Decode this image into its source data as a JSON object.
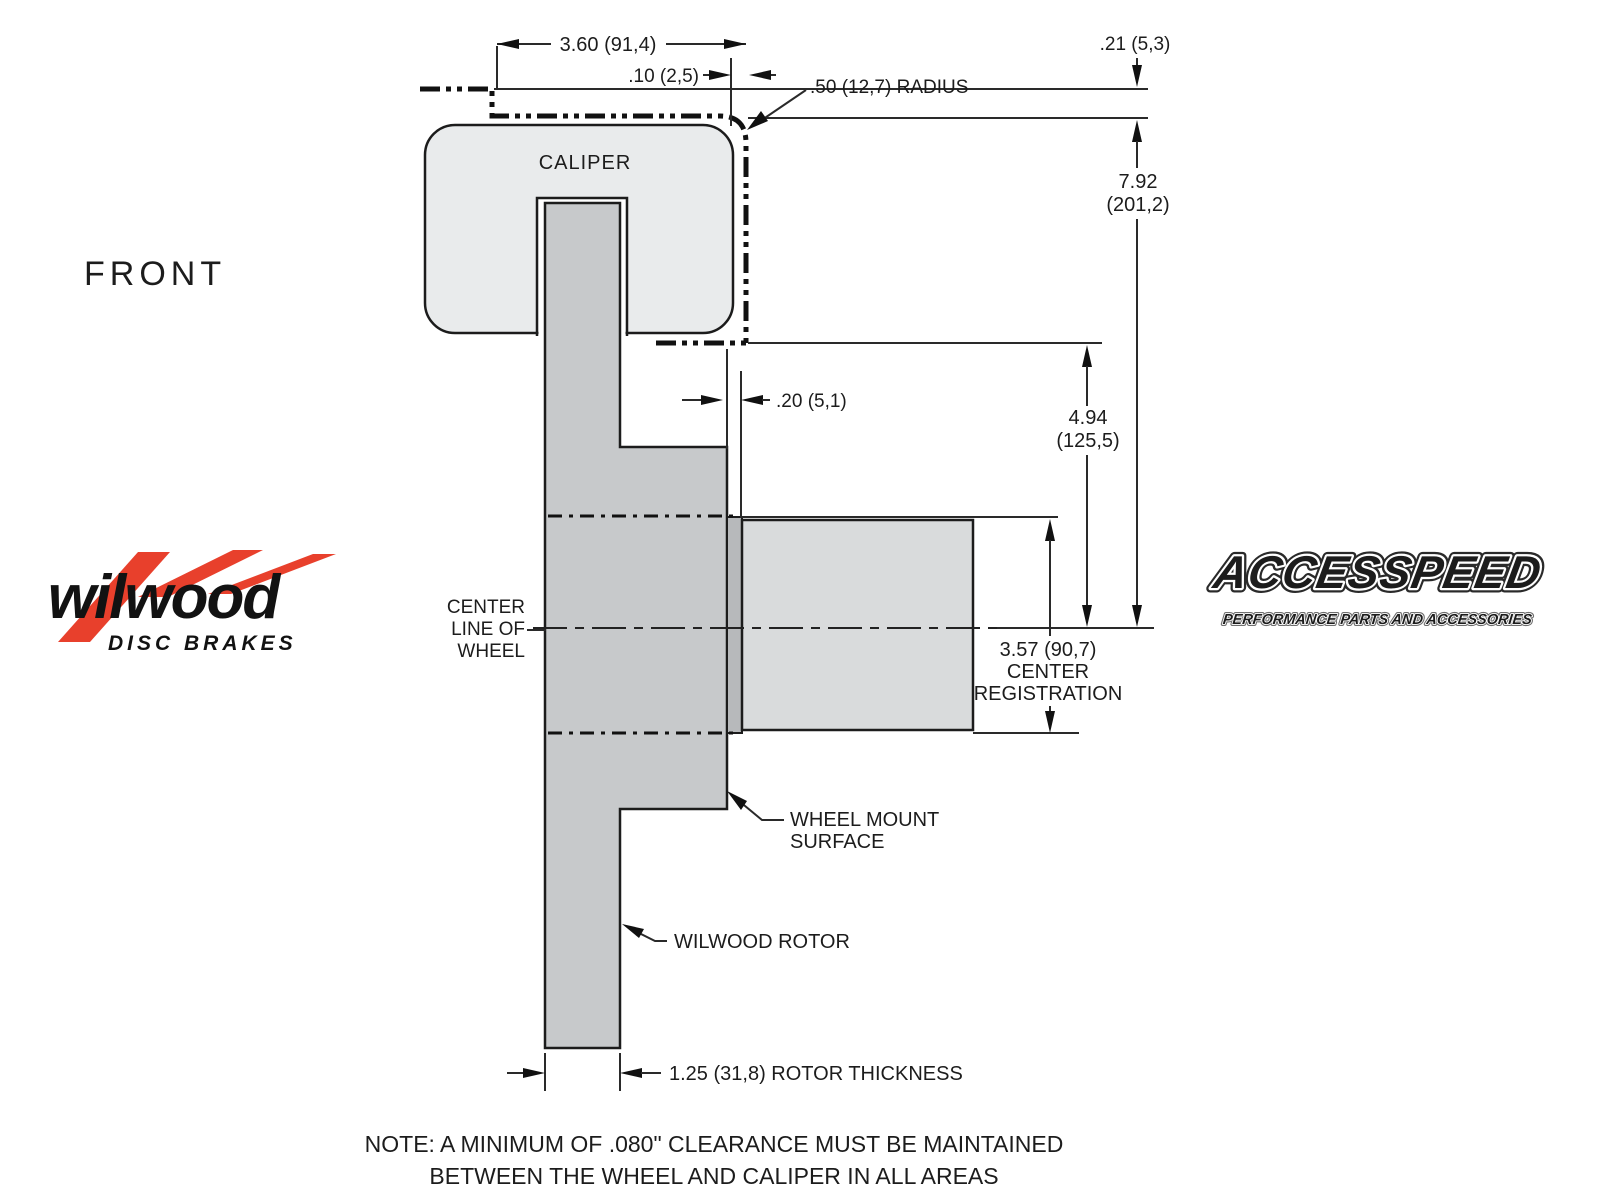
{
  "view_label": "FRONT",
  "colors": {
    "caliper_fill": "#e9ebec",
    "rotor_fill": "#c7c9cb",
    "flange_fill": "#b7b9bb",
    "registration_fill": "#d9dbdc",
    "line": "#1c1c1c",
    "wilwood_red": "#e8402c"
  },
  "caliper": {
    "label": "CALIPER"
  },
  "dimensions": {
    "caliper_width": "3.60 (91,4)",
    "edge_gap": ".10 (2,5)",
    "corner_radius": ".50 (12,7) RADIUS",
    "top_clearance": ".21 (5,3)",
    "outer_radius_in": "7.92",
    "outer_radius_mm": "(201,2)",
    "mount_offset": ".20 (5,1)",
    "inner_radius_in": "4.94",
    "inner_radius_mm": "(125,5)",
    "registration_dia": "3.57 (90,7)",
    "registration_word1": "CENTER",
    "registration_word2": "REGISTRATION",
    "rotor_thickness": "1.25 (31,8) ROTOR THICKNESS"
  },
  "labels": {
    "centerline_1": "CENTER",
    "centerline_2": "LINE OF",
    "centerline_3": "WHEEL",
    "wheel_mount_1": "WHEEL MOUNT",
    "wheel_mount_2": "SURFACE",
    "rotor": "WILWOOD ROTOR"
  },
  "note": {
    "line1": "NOTE: A MINIMUM OF .080\" CLEARANCE MUST BE MAINTAINED",
    "line2": "BETWEEN THE WHEEL AND CALIPER IN ALL AREAS"
  },
  "logos": {
    "wilwood": {
      "name": "wilwood",
      "tagline": "DISC BRAKES"
    },
    "accesspeed": {
      "name": "ACCESSPEED",
      "tagline": "PERFORMANCE PARTS AND ACCESSORIES"
    }
  }
}
